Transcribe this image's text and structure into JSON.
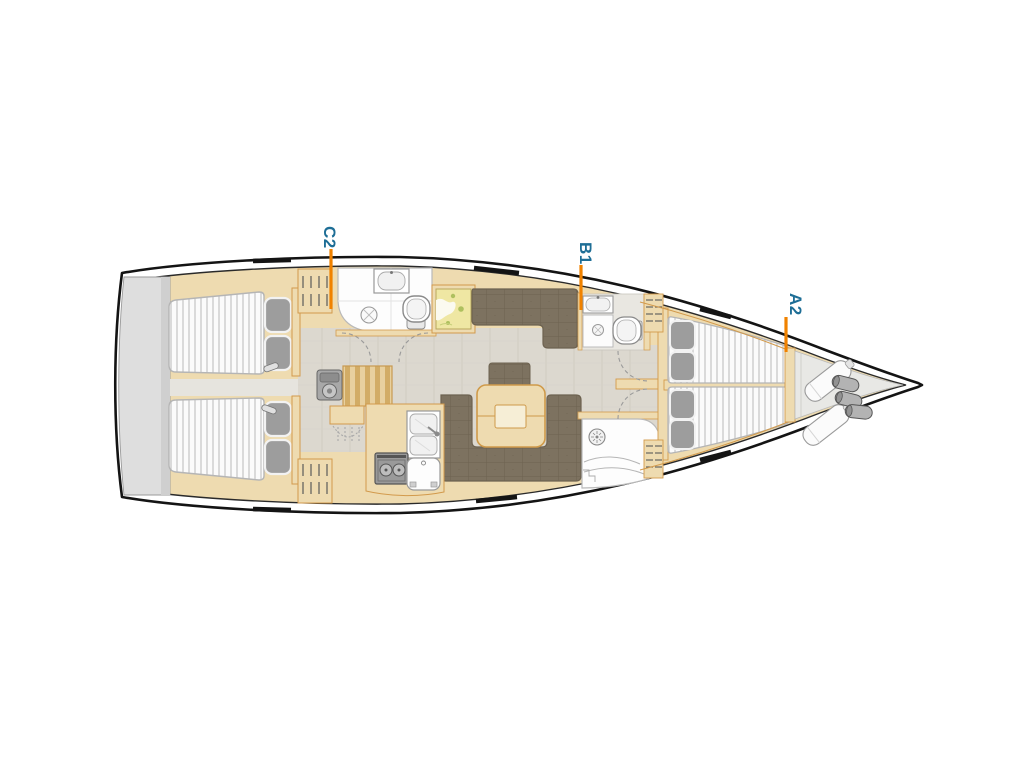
{
  "page": {
    "background_color": "#ffffff"
  },
  "diagram": {
    "name": "sailing-yacht-interior-deck-plan",
    "orientation": "bow-right",
    "colors": {
      "accent_orange": "#f08200",
      "label_teal": "#1e6e96",
      "hull_line": "#141414",
      "woodwork": "#eedbb0",
      "wood_outline": "#d29a4c",
      "floor": "#dcd8cf",
      "upholstery": "#7d7260",
      "transom": "#dedede",
      "mattress": "#fbfbfb",
      "pillow": "#9d9d9d"
    },
    "cabin_labels": [
      {
        "id": "C2"
      },
      {
        "id": "B1"
      },
      {
        "id": "A2"
      }
    ],
    "icons": [
      "toilet-icon",
      "sink-icon",
      "double-sink-icon",
      "stove-icon",
      "fridge-icon",
      "shower-drain-icon",
      "shower-head-icon",
      "hanger-icon",
      "engine-icon",
      "companionway-stairs-icon",
      "chart-table-icon",
      "bed-icon",
      "pillow-icon",
      "reading-light-icon",
      "sail-bag-icon",
      "fender-icon",
      "deck-hatch-icon",
      "door-swing-icon"
    ]
  }
}
